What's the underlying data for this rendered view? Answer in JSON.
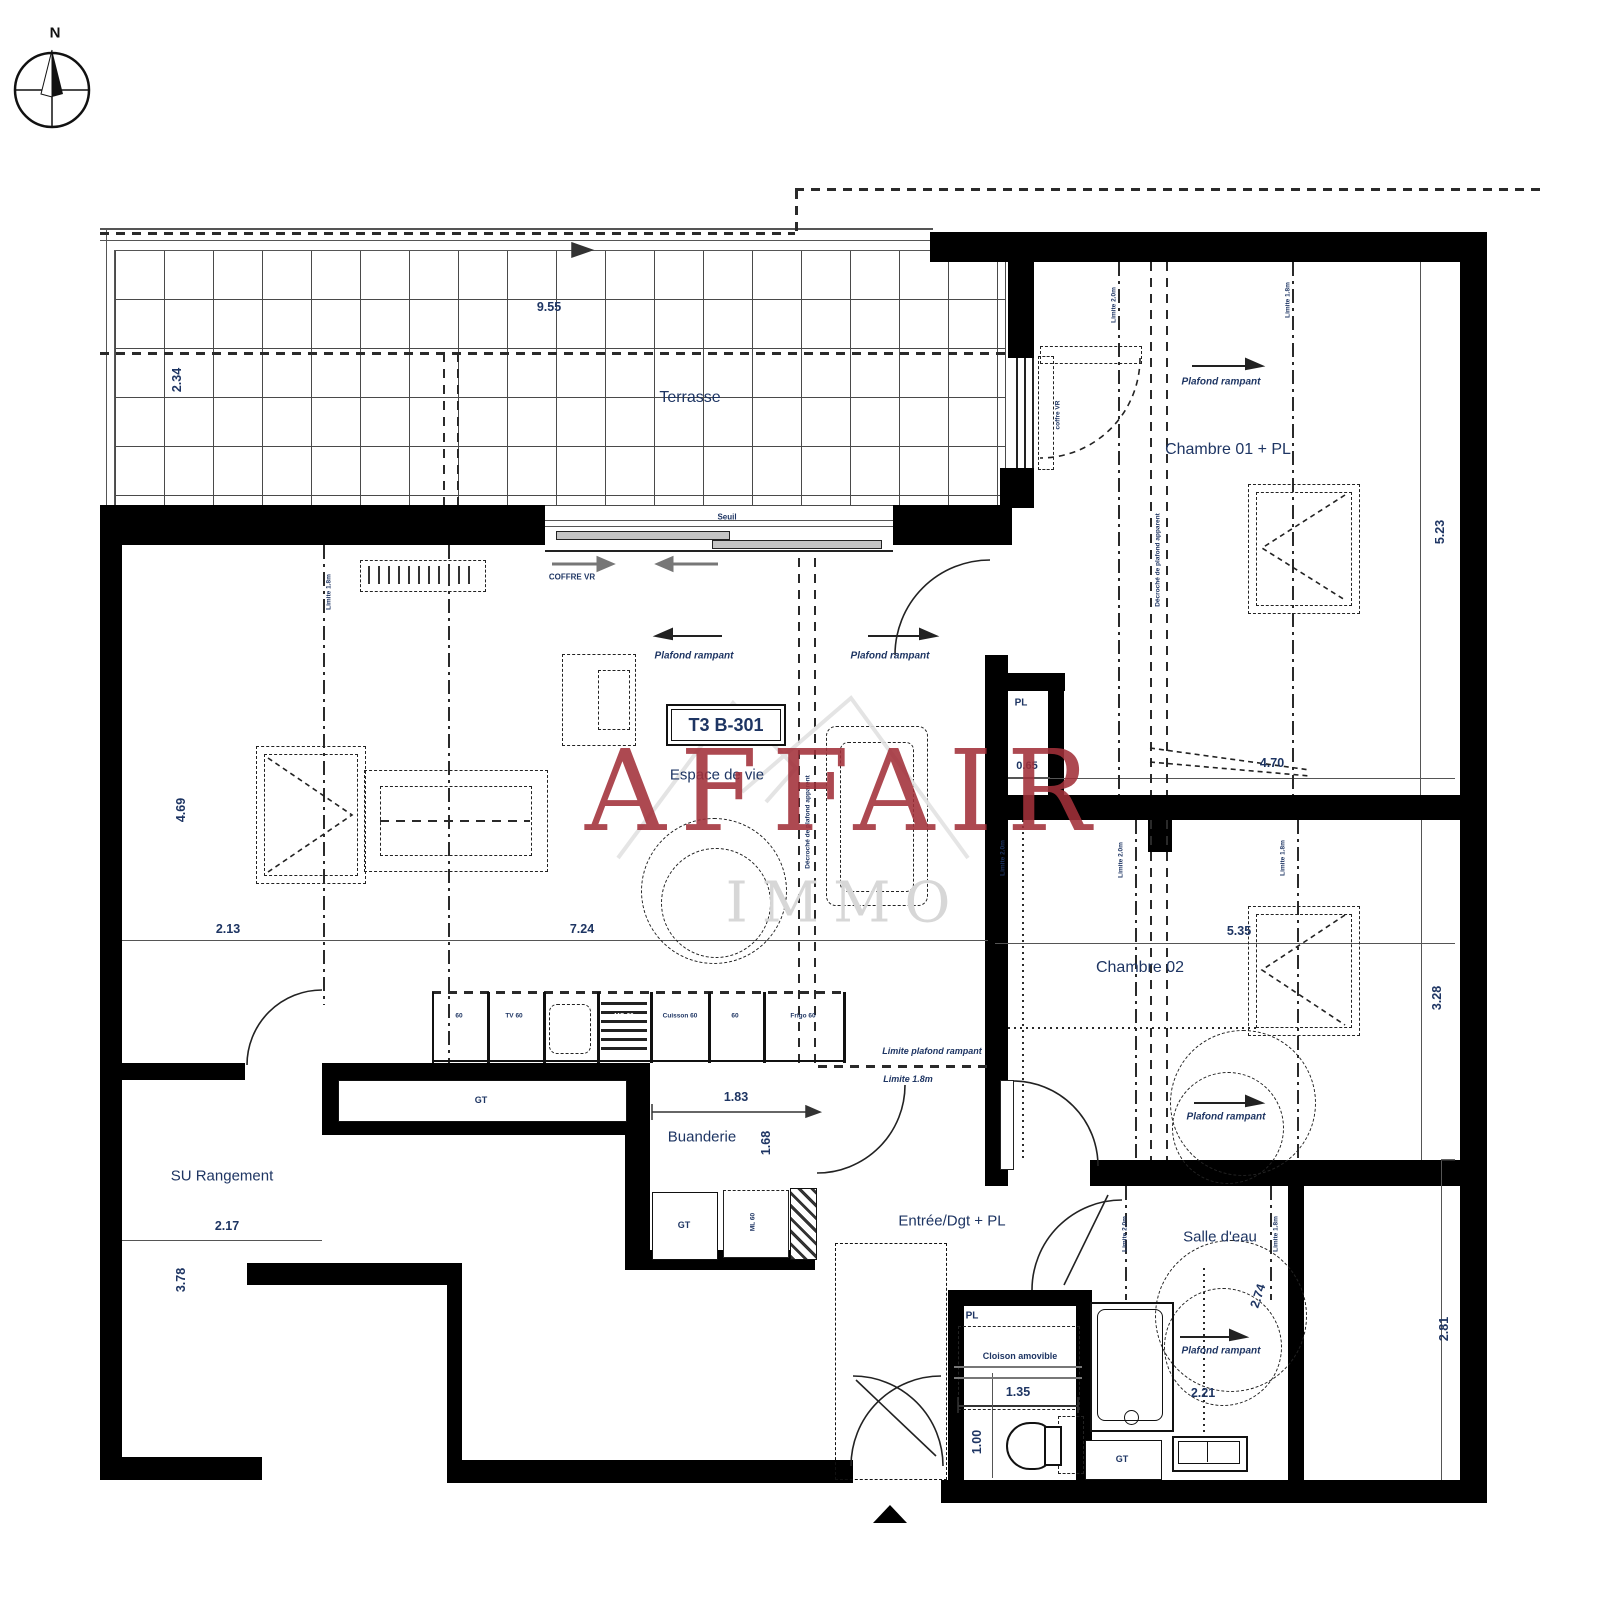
{
  "watermark": {
    "title": "AFFAIR",
    "subtitle": "IMMO",
    "accent_color": "#A2303A"
  },
  "compass": {
    "north": "N"
  },
  "plan": {
    "unit_label": "T3 B-301",
    "rooms": {
      "terrasse": "Terrasse",
      "chambre01": "Chambre 01 + PL",
      "chambre02": "Chambre 02",
      "espace_de_vie": "Espace de vie",
      "buanderie": "Buanderie",
      "entree": "Entrée/Dgt + PL",
      "salle_deau": "Salle d'eau",
      "rangement": "SU Rangement",
      "placard": "PL"
    },
    "dimensions": {
      "terrasse_largeur": "9.55",
      "terrasse_profondeur": "2.34",
      "chambre01_hauteur": "5.23",
      "chambre01_largeur": "4.70",
      "placard_largeur": "0.65",
      "espace_hauteur": "4.69",
      "espace_gauche": "2.13",
      "espace_largeur": "7.24",
      "chambre02_largeur": "5.35",
      "chambre02_hauteur": "3.28",
      "rangement_largeur": "2.17",
      "rangement_hauteur": "3.78",
      "buanderie_largeur": "1.83",
      "buanderie_hauteur": "1.68",
      "cloison_largeur": "1.35",
      "wc_largeur": "1.00",
      "salle_deau_largeur": "2.21",
      "salle_deau_diagonale": "2.74",
      "droite_hauteur": "2.81"
    },
    "annotations": {
      "plafond_rampant": "Plafond rampant",
      "limite_plafond_rampant": "Limite plafond rampant",
      "limite_18": "Limite 1.8m",
      "limite_20": "Limite 2.0m",
      "decroche_plafond": "Décroché de plafond apparent",
      "seuil": "Seuil",
      "coffre_vr": "COFFRE VR",
      "coffre_vr_fenetre": "coffre VR",
      "cloison_amovible": "Cloison amovible",
      "gaine_technique": "GT",
      "lave_linge": "ML 60"
    },
    "kitchen": {
      "cells": [
        "60",
        "TV 60",
        "",
        "MO 60",
        "Cuisson 60",
        "60",
        "Frigo 60"
      ]
    }
  }
}
